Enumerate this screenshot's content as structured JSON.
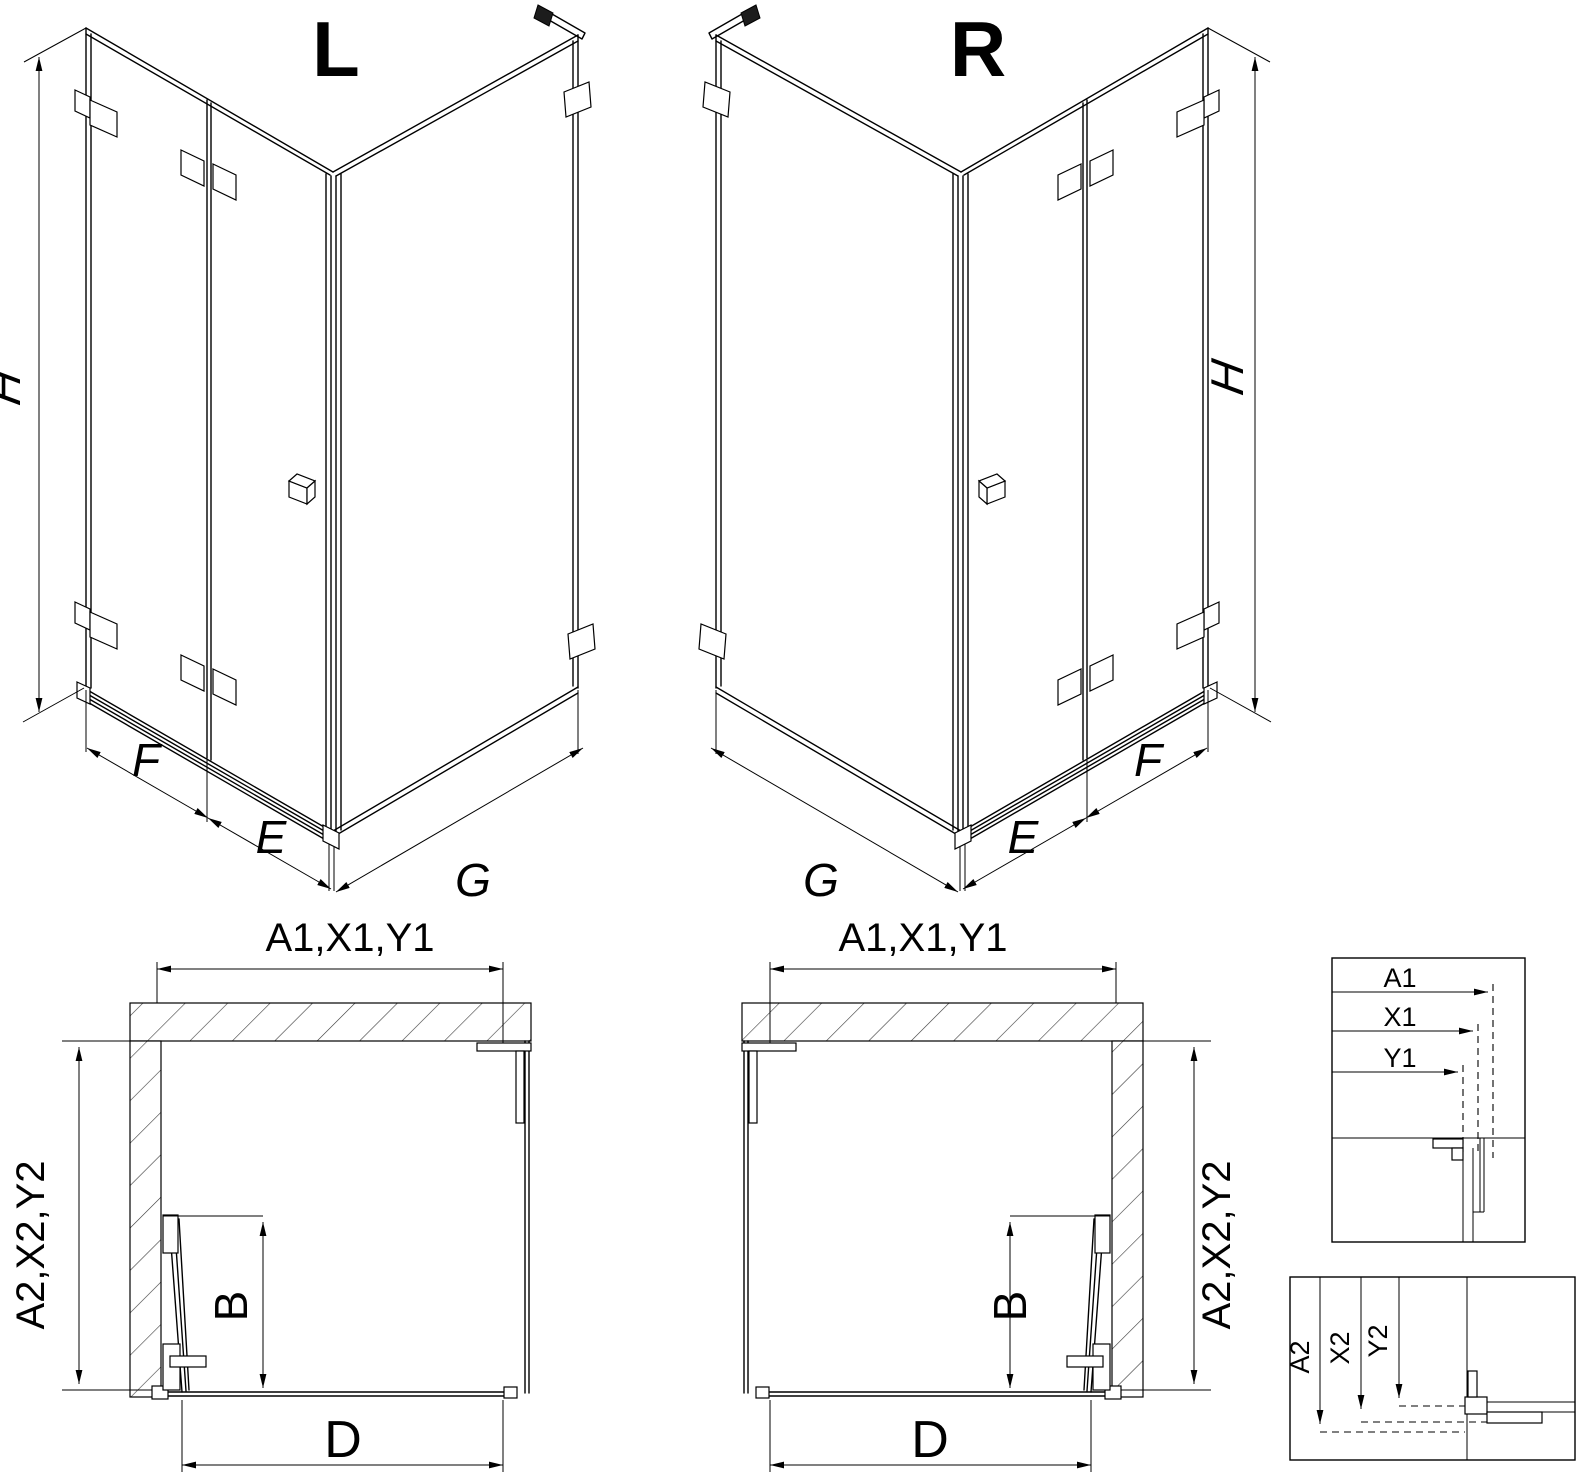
{
  "drawing": {
    "kind": "corner shower enclosure installation drawing",
    "colors": {
      "ink": "#000000",
      "background": "#ffffff"
    }
  },
  "views": {
    "iso_left": {
      "label": "L",
      "dims": {
        "height": "H",
        "front": "F",
        "inner": "E",
        "side": "G"
      }
    },
    "iso_right": {
      "label": "R",
      "dims": {
        "height": "H",
        "front": "F",
        "inner": "E",
        "side": "G"
      }
    }
  },
  "plans": {
    "left": {
      "top_label": "A1,X1,Y1",
      "side_label": "A2,X2,Y2",
      "door_label": "B",
      "entry_label": "D"
    },
    "right": {
      "top_label": "A1,X1,Y1",
      "side_label": "A2,X2,Y2",
      "door_label": "B",
      "entry_label": "D"
    }
  },
  "details": {
    "top_box": {
      "row1": "A1",
      "row2": "X1",
      "row3": "Y1"
    },
    "bottom_box": {
      "row1": "A2",
      "row2": "X2",
      "row3": "Y2"
    }
  }
}
